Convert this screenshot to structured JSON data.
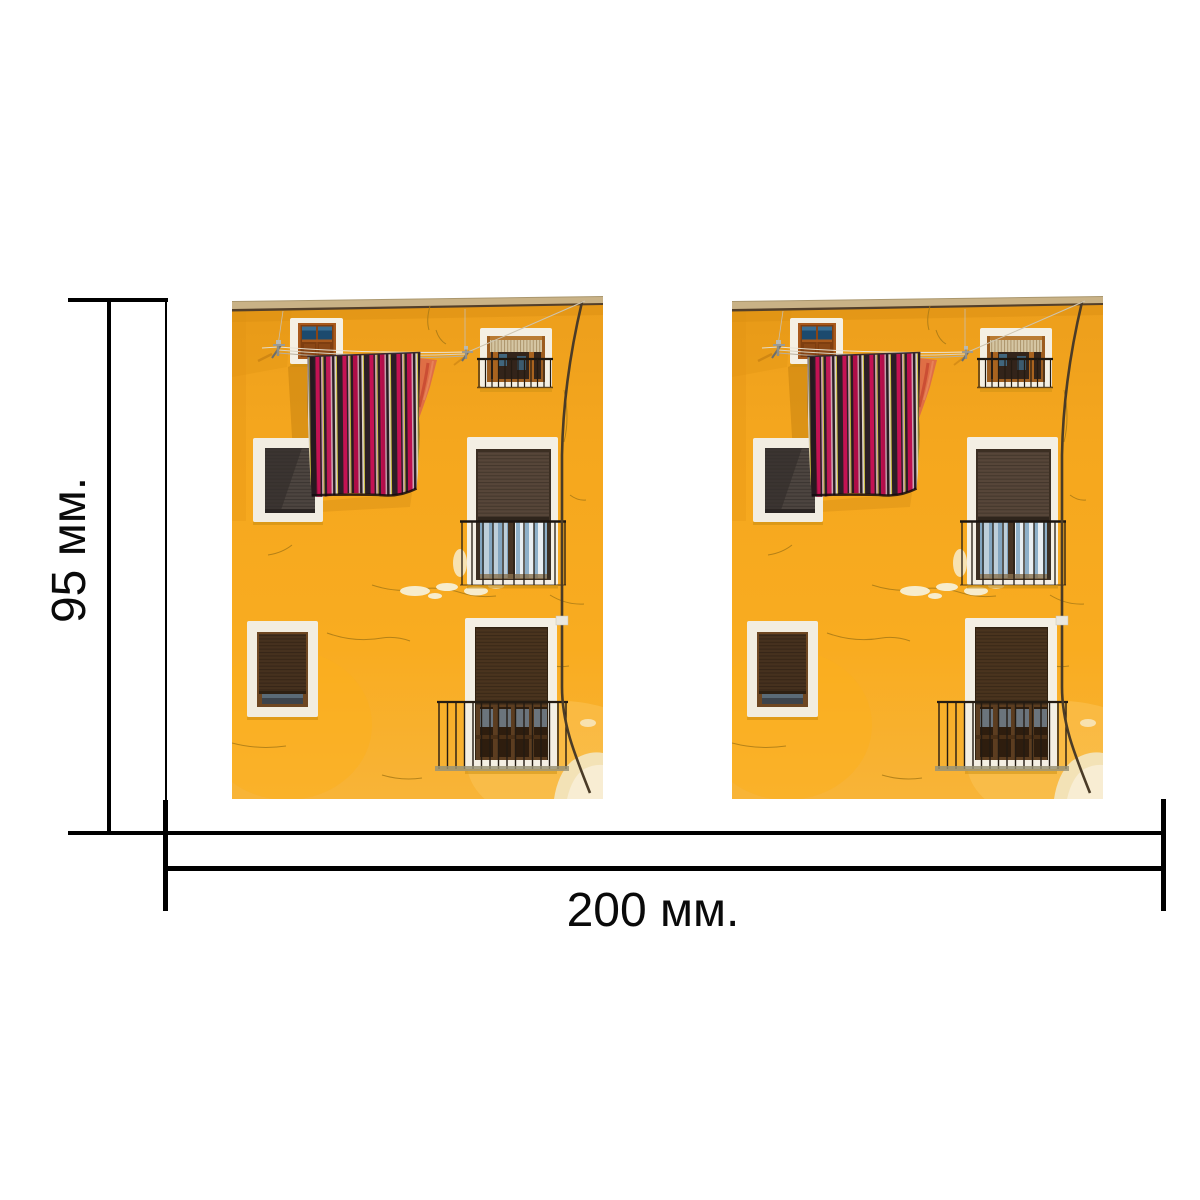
{
  "dimensions": {
    "height": {
      "label": "95 мм.",
      "value": 95,
      "unit": "мм"
    },
    "width": {
      "label": "200 мм.",
      "value": 200,
      "unit": "мм"
    }
  },
  "photos": {
    "count": 2,
    "description": "Yellow plastered building facade in sunlight with six white-framed windows, brown roller shutters, two small balconies with black railings, a drainpipe, wall cracks and a dark striped blanket with red, pink and yellow stripes drying on a clothesline next to an orange towel"
  },
  "style": {
    "background": "#FFFFFF",
    "line_color": "#000000",
    "text_color": "#0A0A0A",
    "wall_color": "#F7A71F",
    "roof_trim_color": "#C9B286",
    "window_surround_color": "#F4EFE3",
    "shutter_color": "#4A341E",
    "blanket_dark": "#2C1E26",
    "blanket_red": "#C41253",
    "towel_color": "#DF6E45"
  }
}
